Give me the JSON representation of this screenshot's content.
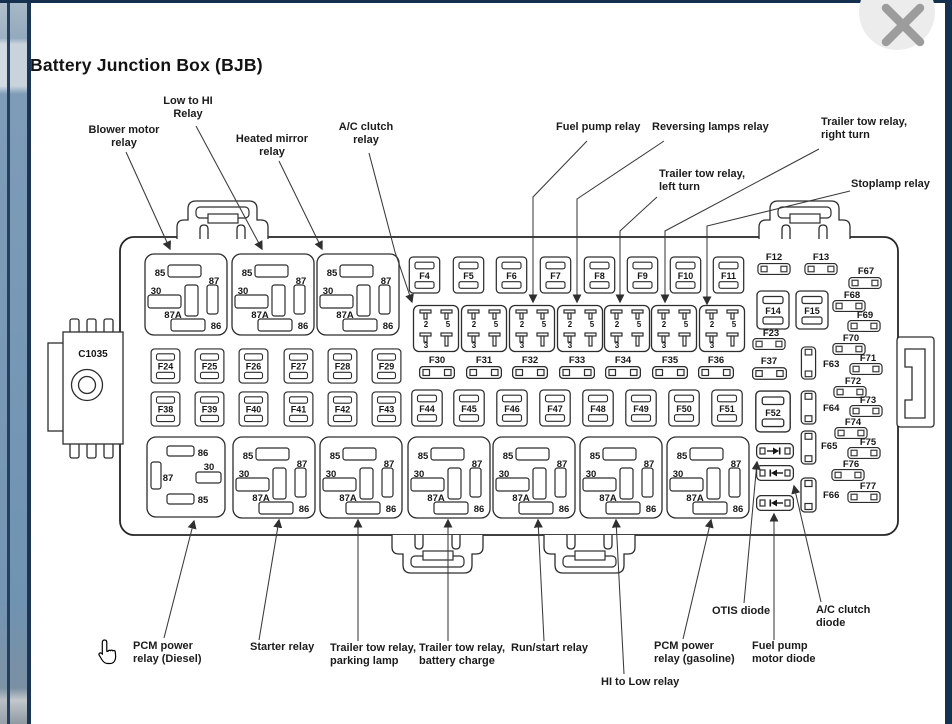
{
  "title": "Battery Junction Box (BJB)",
  "icons": {
    "close": "close-icon",
    "cursor": "hand-pointer-icon"
  },
  "colors": {
    "frame_strip": "#7E9AB6",
    "frame_border": "#1B3553",
    "diagram_line": "#2D2D2D",
    "close_bg": "#ECECEC",
    "close_x": "#9C9C9C"
  },
  "connector_label": "C1035",
  "relay_pins": {
    "p85": "85",
    "p30": "30",
    "p87": "87",
    "p87a": "87A",
    "p86": "86"
  },
  "small_relay_pins": {
    "p2": "2",
    "p5": "5",
    "p3": "3"
  },
  "fuses": {
    "top_row": [
      "F4",
      "F5",
      "F6",
      "F7",
      "F8",
      "F9",
      "F10",
      "F11"
    ],
    "mid_row1": [
      "F24",
      "F25",
      "F26",
      "F27",
      "F28",
      "F29"
    ],
    "mini_row": [
      "F30",
      "F31",
      "F32",
      "F33",
      "F34",
      "F35",
      "F36"
    ],
    "mid_row2": [
      "F38",
      "F39",
      "F40",
      "F41",
      "F42",
      "F43"
    ],
    "mid_row3": [
      "F44",
      "F45",
      "F46",
      "F47",
      "F48",
      "F49",
      "F50",
      "F51"
    ],
    "right": {
      "f12": "F12",
      "f13": "F13",
      "f14": "F14",
      "f15": "F15",
      "f23": "F23",
      "f37": "F37",
      "f52": "F52",
      "f63": "F63",
      "f64": "F64",
      "f65": "F65",
      "f66": "F66",
      "f67": "F67",
      "f68": "F68",
      "f69": "F69",
      "f70": "F70",
      "f71": "F71",
      "f72": "F72",
      "f73": "F73",
      "f74": "F74",
      "f75": "F75",
      "f76": "F76",
      "f77": "F77"
    }
  },
  "callouts": {
    "blower": "Blower motor\nrelay",
    "low_hi": "Low to HI\nRelay",
    "heated_mirror": "Heated mirror\nrelay",
    "ac_clutch": "A/C clutch\nrelay",
    "fuel_pump": "Fuel pump relay",
    "reversing": "Reversing lamps relay",
    "trailer_left": "Trailer tow relay,\nleft turn",
    "trailer_right": "Trailer tow relay,\nright turn",
    "stoplamp": "Stoplamp relay",
    "pcm_diesel": "PCM power\nrelay (Diesel)",
    "starter": "Starter relay",
    "trailer_parking": "Trailer tow relay,\nparking lamp",
    "trailer_battery": "Trailer tow relay,\nbattery charge",
    "run_start": "Run/start relay",
    "hi_low": "HI to Low relay",
    "pcm_gasoline": "PCM power\nrelay (gasoline)",
    "otis_diode": "OTIS diode",
    "fuel_pump_diode": "Fuel pump\nmotor diode",
    "ac_clutch_diode": "A/C clutch\ndiode"
  }
}
